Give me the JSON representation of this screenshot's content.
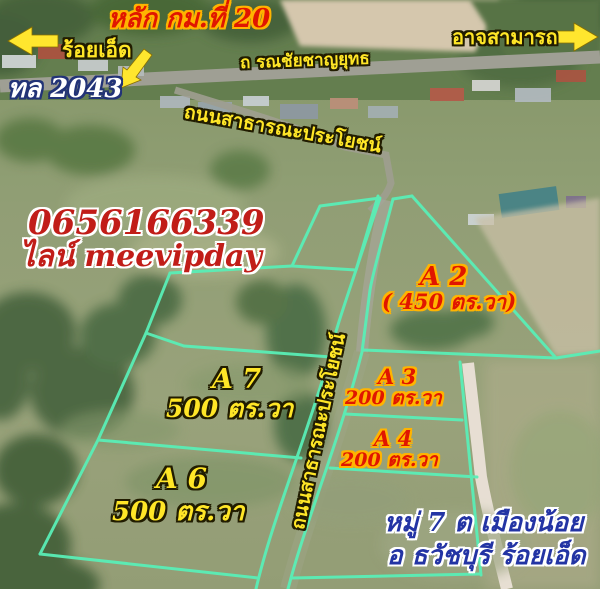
{
  "ad": {
    "phone": "0656166339",
    "line_account": "ไลน์ meevipday"
  },
  "top_labels": {
    "km_marker": "หลัก กม.ที่ 20",
    "left_destination": "ร้อยเอ็ด",
    "highway_no": "ทล 2043",
    "right_destination": "อาจสามารถ",
    "main_road": "ถ รณชัยชาญยุทธ",
    "public_road": "ถนนสาธารณะประโยชน์"
  },
  "roads": {
    "central_road": "ถนนสาธารณะประโยชน์"
  },
  "plots": [
    {
      "id": "A 2",
      "area": "( 450 ตร.วา)",
      "label_style": "red-on-yellow"
    },
    {
      "id": "A 7",
      "area": "500 ตร.วา",
      "label_style": "yellow-on-black"
    },
    {
      "id": "A 3",
      "area": "200 ตร.วา",
      "label_style": "red-on-yellow"
    },
    {
      "id": "A 4",
      "area": "200 ตร.วา",
      "label_style": "red-on-yellow"
    },
    {
      "id": "A 6",
      "area": "500 ตร.วา",
      "label_style": "yellow-on-black"
    }
  ],
  "location": {
    "line1": "หมู่ 7 ต เมืองน้อย",
    "line2": "อ ธวัชบุรี ร้อยเอ็ด"
  },
  "colors": {
    "plot_boundary": "#59eeb6",
    "label_yellow": "#ffe627",
    "label_red": "#e01600",
    "label_navy": "#2334a4",
    "arrow_yellow": "#ffe62e"
  }
}
